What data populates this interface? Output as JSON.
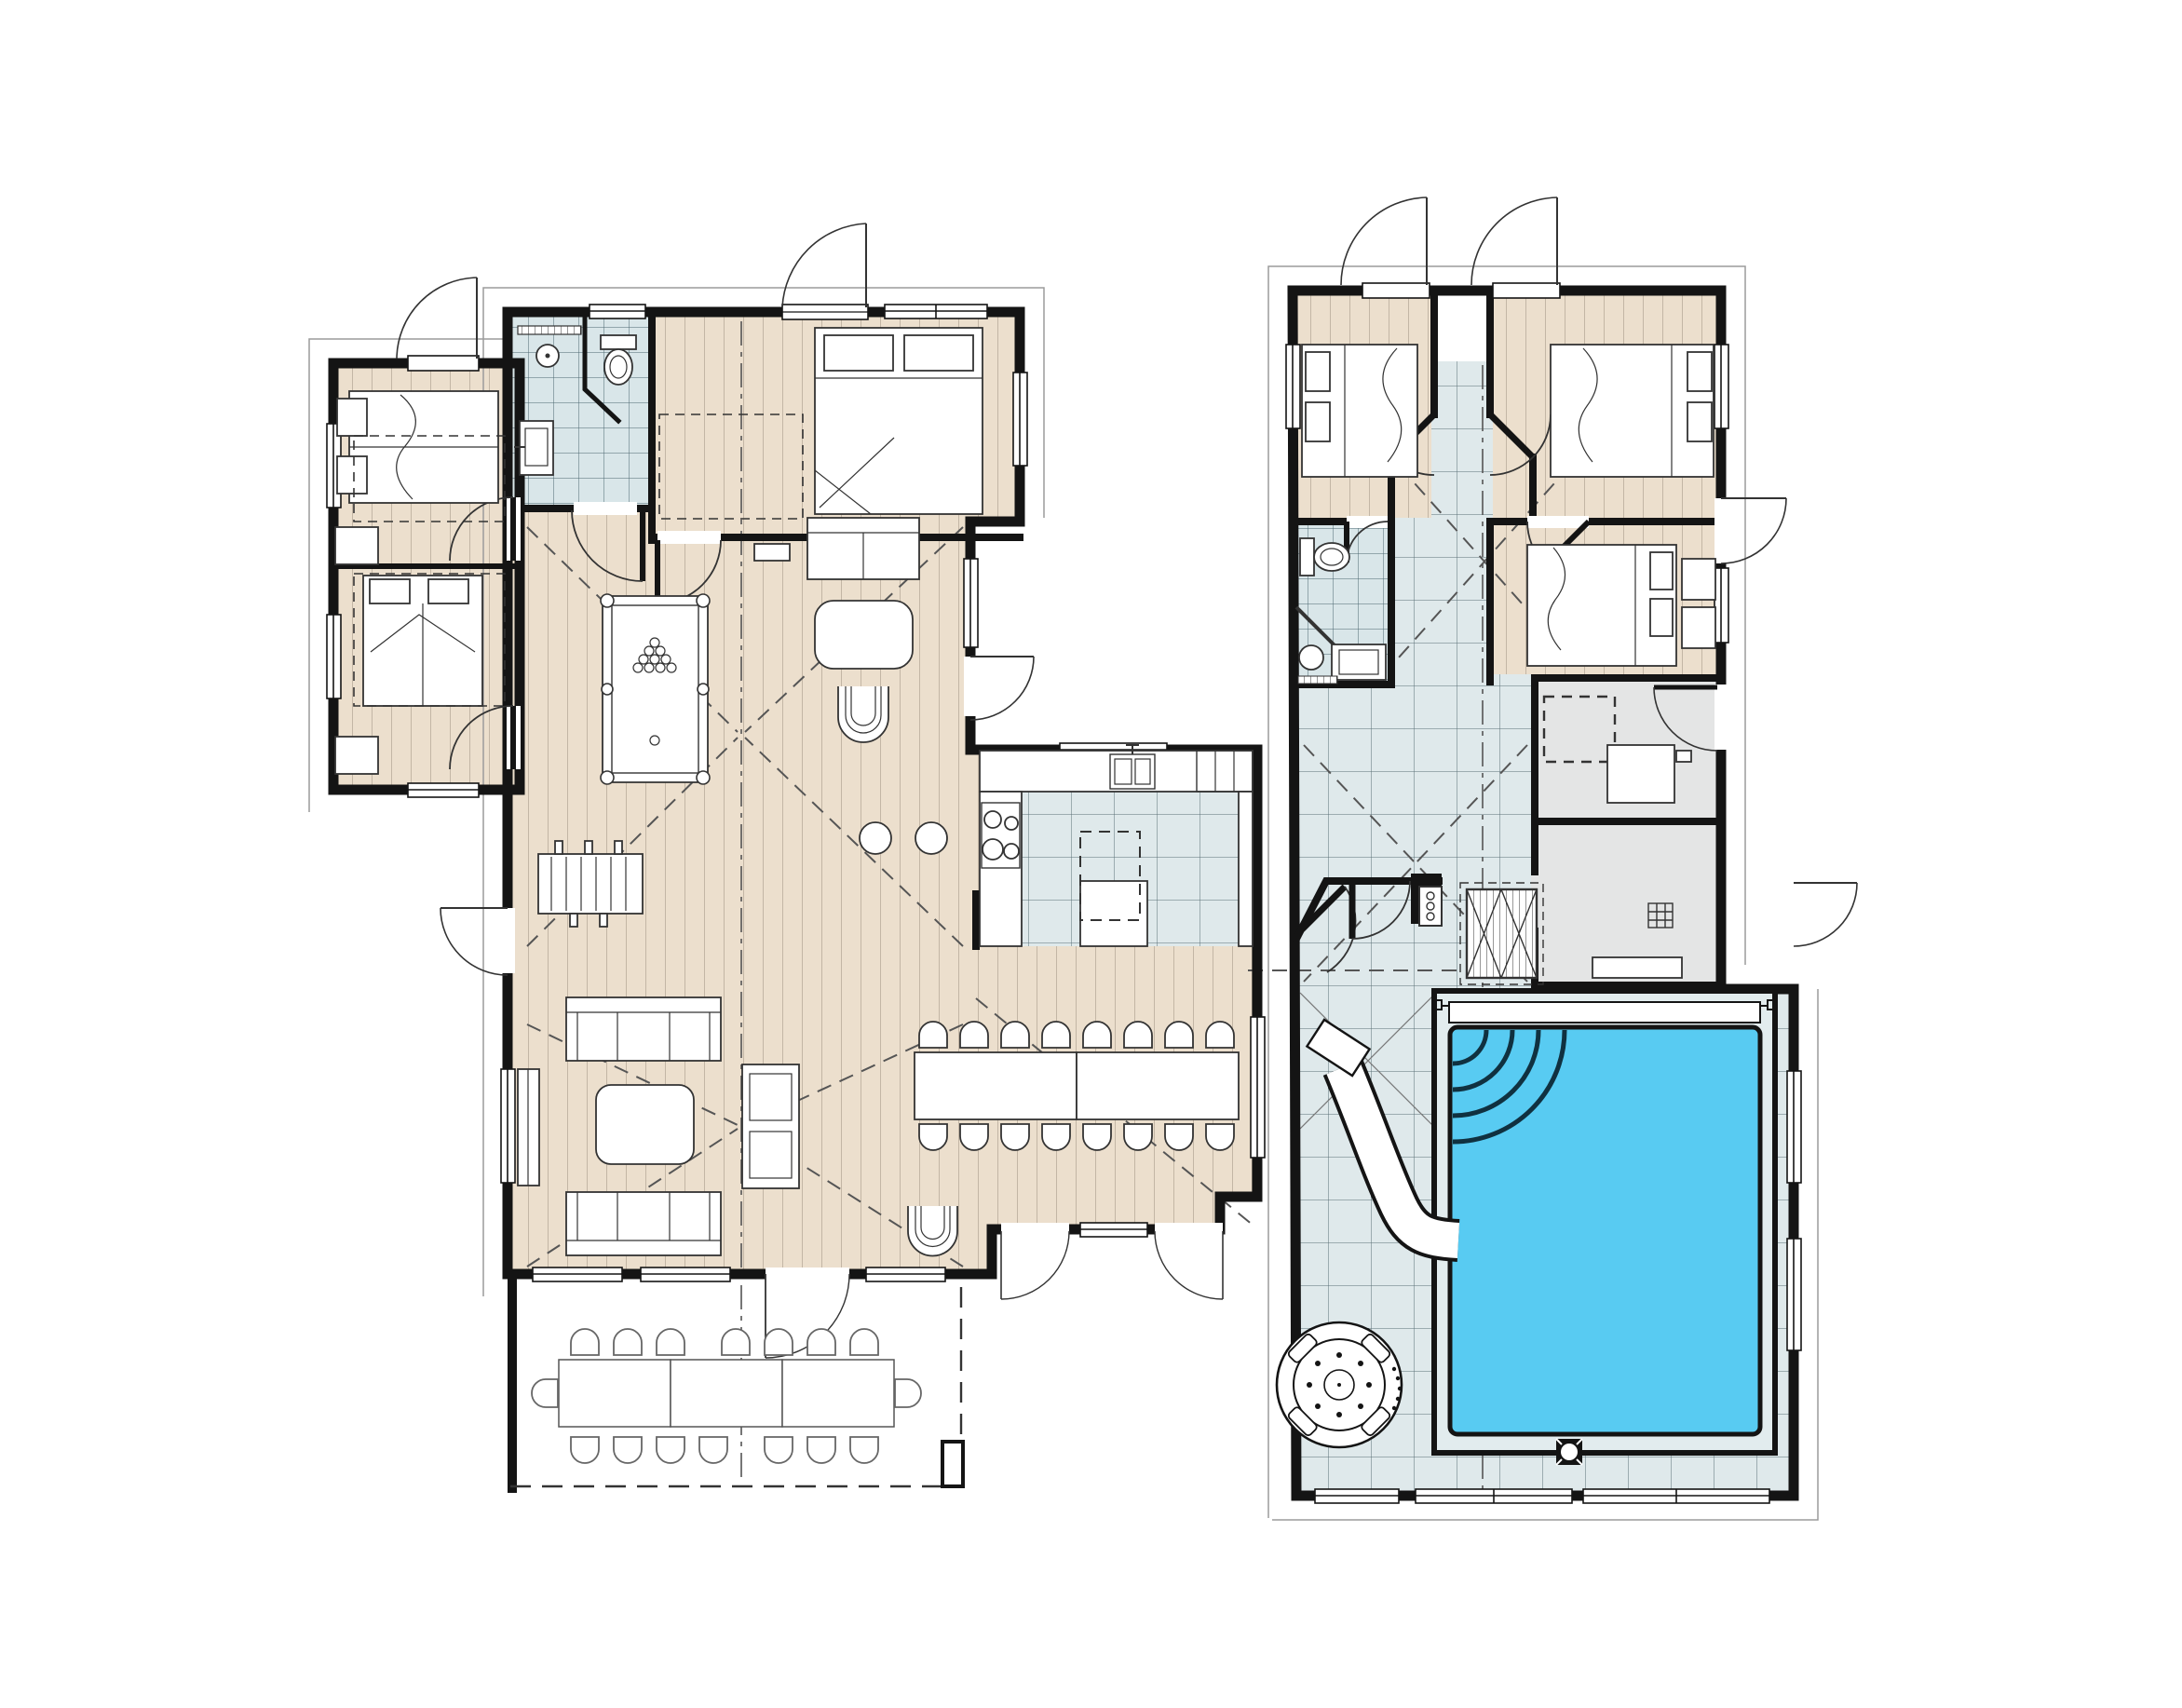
{
  "meta": {
    "title": "holiday-villa-floor-plan",
    "type": "architectural floor plan, top view, no text labels",
    "wings": [
      "left-living-wing",
      "right-pool-wing"
    ]
  },
  "colors": {
    "paper": "#FFFFFF",
    "wall": "#141414",
    "wood_floor": "#ECDFCD",
    "wood_stripe": "#B9AC9B",
    "bath_tile": "#D9E6E9",
    "bath_grid": "#4A6670",
    "pool_tile": "#DFE9EB",
    "pool_grid": "#3A4E56",
    "gray_room": "#E4E5E5",
    "pool_water": "#58CBF2",
    "water_line": "#103140",
    "thin_line": "#333333",
    "roof_dash": "#555555",
    "overhang": "#9B9B9B"
  },
  "left_wing": {
    "rooms": [
      {
        "name": "annex-bedroom-1",
        "floor": "wood",
        "furniture": [
          "double-bed",
          "nightstands",
          "dresser",
          "door"
        ]
      },
      {
        "name": "annex-bedroom-2",
        "floor": "wood",
        "furniture": [
          "double-bed",
          "two-pillows",
          "dresser",
          "door"
        ]
      },
      {
        "name": "bathroom-shower-wc",
        "floor": "tile",
        "furniture": [
          "shower-head",
          "toilet",
          "sink",
          "door"
        ]
      },
      {
        "name": "bedroom-master",
        "floor": "wood",
        "furniture": [
          "double-bed",
          "wardrobe-dashed",
          "door",
          "windows"
        ]
      },
      {
        "name": "games-hall",
        "floor": "wood",
        "furniture": [
          "billiard-table",
          "cue-rack",
          "bench"
        ]
      },
      {
        "name": "study-nook",
        "floor": "wood",
        "furniture": [
          "two-seat-sofa",
          "table",
          "u-armchair",
          "bar-stools"
        ]
      },
      {
        "name": "kitchen",
        "floor": "tile",
        "furniture": [
          "l-counter",
          "cooktop-4-burners",
          "double-sink",
          "fridge-cabinet",
          "island-with-hood"
        ]
      },
      {
        "name": "living-room",
        "floor": "wood",
        "furniture": [
          "sofa-3-seat-a",
          "sofa-3-seat-b",
          "coffee-table",
          "tv-sideboard",
          "shelf-unit"
        ]
      },
      {
        "name": "dining-room",
        "floor": "wood",
        "furniture": [
          "long-table-2-sections",
          "chairs-x16",
          "u-armchair",
          "bay-window",
          "french-doors"
        ]
      }
    ]
  },
  "right_wing": {
    "rooms": [
      {
        "name": "bedroom-r1",
        "floor": "wood",
        "furniture": [
          "double-bed-headboard-left",
          "exterior-door"
        ]
      },
      {
        "name": "closet-niche",
        "floor": "white",
        "furniture": []
      },
      {
        "name": "bedroom-r2",
        "floor": "wood",
        "furniture": [
          "double-bed-headboard-right",
          "exterior-door"
        ]
      },
      {
        "name": "bedroom-r3",
        "floor": "wood",
        "furniture": [
          "double-bed",
          "dresser",
          "angled-door"
        ]
      },
      {
        "name": "bathroom-r",
        "floor": "tile",
        "furniture": [
          "toilet",
          "round-basin",
          "vanity",
          "door"
        ]
      },
      {
        "name": "central-hall",
        "floor": "tile",
        "furniture": [
          "butterfly-doors"
        ]
      },
      {
        "name": "utility-laundry",
        "floor": "gray",
        "furniture": [
          "washer-dashed",
          "counter",
          "door"
        ]
      },
      {
        "name": "drying-shower-room",
        "floor": "gray",
        "furniture": [
          "floor-drain",
          "bench",
          "exterior-door"
        ]
      },
      {
        "name": "pool-hall",
        "floor": "tile",
        "furniture": [
          "swimming-pool",
          "pool-steps-arcs",
          "water-slide",
          "hot-tub",
          "skimmer",
          "locker-bench-x",
          "shower-panel",
          "double-entry-doors"
        ]
      }
    ]
  },
  "outdoor": {
    "terrace": {
      "name": "terrace",
      "furniture": [
        "outdoor-table-3-sections",
        "chairs-x16",
        "column"
      ],
      "boundary": "dashed"
    }
  },
  "counts": {
    "bedrooms": 7,
    "bathrooms": 3,
    "dining_chairs": 16,
    "terrace_chairs": 16,
    "bar_stools": 2,
    "sofas": 3,
    "pool_steps_arcs": 4,
    "cooktop_burners": 4
  }
}
